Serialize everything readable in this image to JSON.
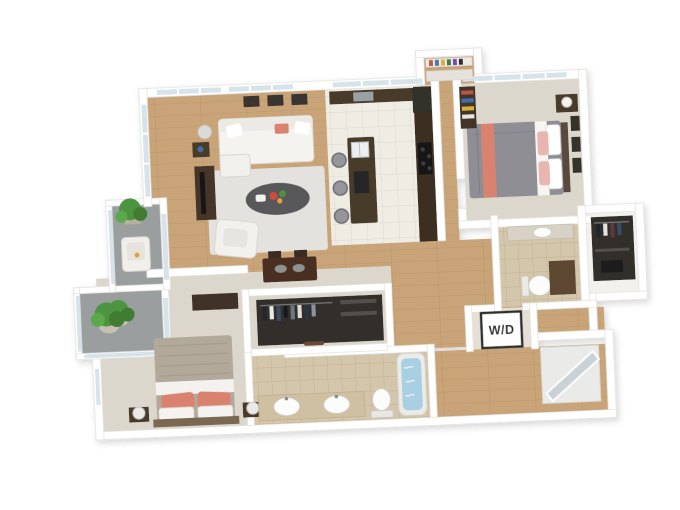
{
  "figure": {
    "type": "3d-floor-plan",
    "view": "isometric-top-down",
    "description": "3D rendered floor plan of a two-bedroom, two-bathroom apartment with open living/kitchen area, walk-in closets, laundry closet and two balconies"
  },
  "labels": {
    "washer_dryer": "W/D"
  },
  "colors": {
    "wood": "#c9a478",
    "tile-white": "#efece4",
    "tile-beige": "#d3c6aa",
    "carpet": "#dcd7cc",
    "balcony": "#9a9e9f",
    "wall": "#ffffff",
    "wall-shade": "#e3e0da",
    "cabinet": "#4a3a2b",
    "espresso": "#3c2f24",
    "glass": "#d7e3ea",
    "accent-coral": "#d9826f",
    "pink": "#e7b6b0",
    "bed-gray": "#8e8e94",
    "blanket-beige": "#b3a99b",
    "plant": "#4e9440",
    "water": "#a9cfe2",
    "closet-dark": "#322d29",
    "rug": "#e3e2de",
    "label": "#333333"
  },
  "rooms": [
    {
      "id": "living-room",
      "floor": "hardwood",
      "furniture": [
        "sofa",
        "coffee-table",
        "area-rug",
        "tv-stand",
        "tv",
        "armchair",
        "floor-lamp",
        "side-table",
        "wall-art-frames"
      ]
    },
    {
      "id": "dining-area",
      "floor": "hardwood",
      "furniture": [
        "dining-table",
        "dining-chairs"
      ]
    },
    {
      "id": "kitchen",
      "floor": "white-tile",
      "furniture": [
        "island-with-sink",
        "bar-stools",
        "counter-run",
        "refrigerator",
        "cooktop"
      ]
    },
    {
      "id": "entry-pantry",
      "floor": "hardwood",
      "furniture": [
        "pantry-shelf"
      ]
    },
    {
      "id": "bedroom-2",
      "floor": "carpet",
      "furniture": [
        "bed",
        "nightstand",
        "table-lamp",
        "bookshelf",
        "wall-art-frames"
      ]
    },
    {
      "id": "master-bedroom",
      "floor": "carpet",
      "furniture": [
        "bed",
        "nightstands",
        "table-lamps",
        "dresser",
        "potted-plant"
      ]
    },
    {
      "id": "walk-in-closet",
      "floor": "carpet",
      "furniture": [
        "hanging-clothes"
      ]
    },
    {
      "id": "master-bathroom",
      "floor": "beige-tile",
      "furniture": [
        "double-vanity",
        "toilet",
        "bathtub"
      ]
    },
    {
      "id": "bathroom-2",
      "floor": "beige-tile",
      "furniture": [
        "vanity",
        "toilet",
        "cabinet"
      ]
    },
    {
      "id": "closet-2",
      "floor": "white",
      "furniture": [
        "hanging-clothes",
        "shelf"
      ]
    },
    {
      "id": "laundry-closet",
      "floor": "beige-tile",
      "furniture": [
        "washer-dryer"
      ]
    },
    {
      "id": "hallway",
      "floor": "hardwood",
      "furniture": []
    },
    {
      "id": "shower-room",
      "floor": "hardwood",
      "furniture": [
        "glass-shower"
      ]
    },
    {
      "id": "balcony-upper",
      "floor": "concrete",
      "furniture": [
        "lounge-chair",
        "potted-plant"
      ]
    },
    {
      "id": "balcony-lower",
      "floor": "concrete",
      "furniture": [
        "potted-plant"
      ]
    }
  ]
}
